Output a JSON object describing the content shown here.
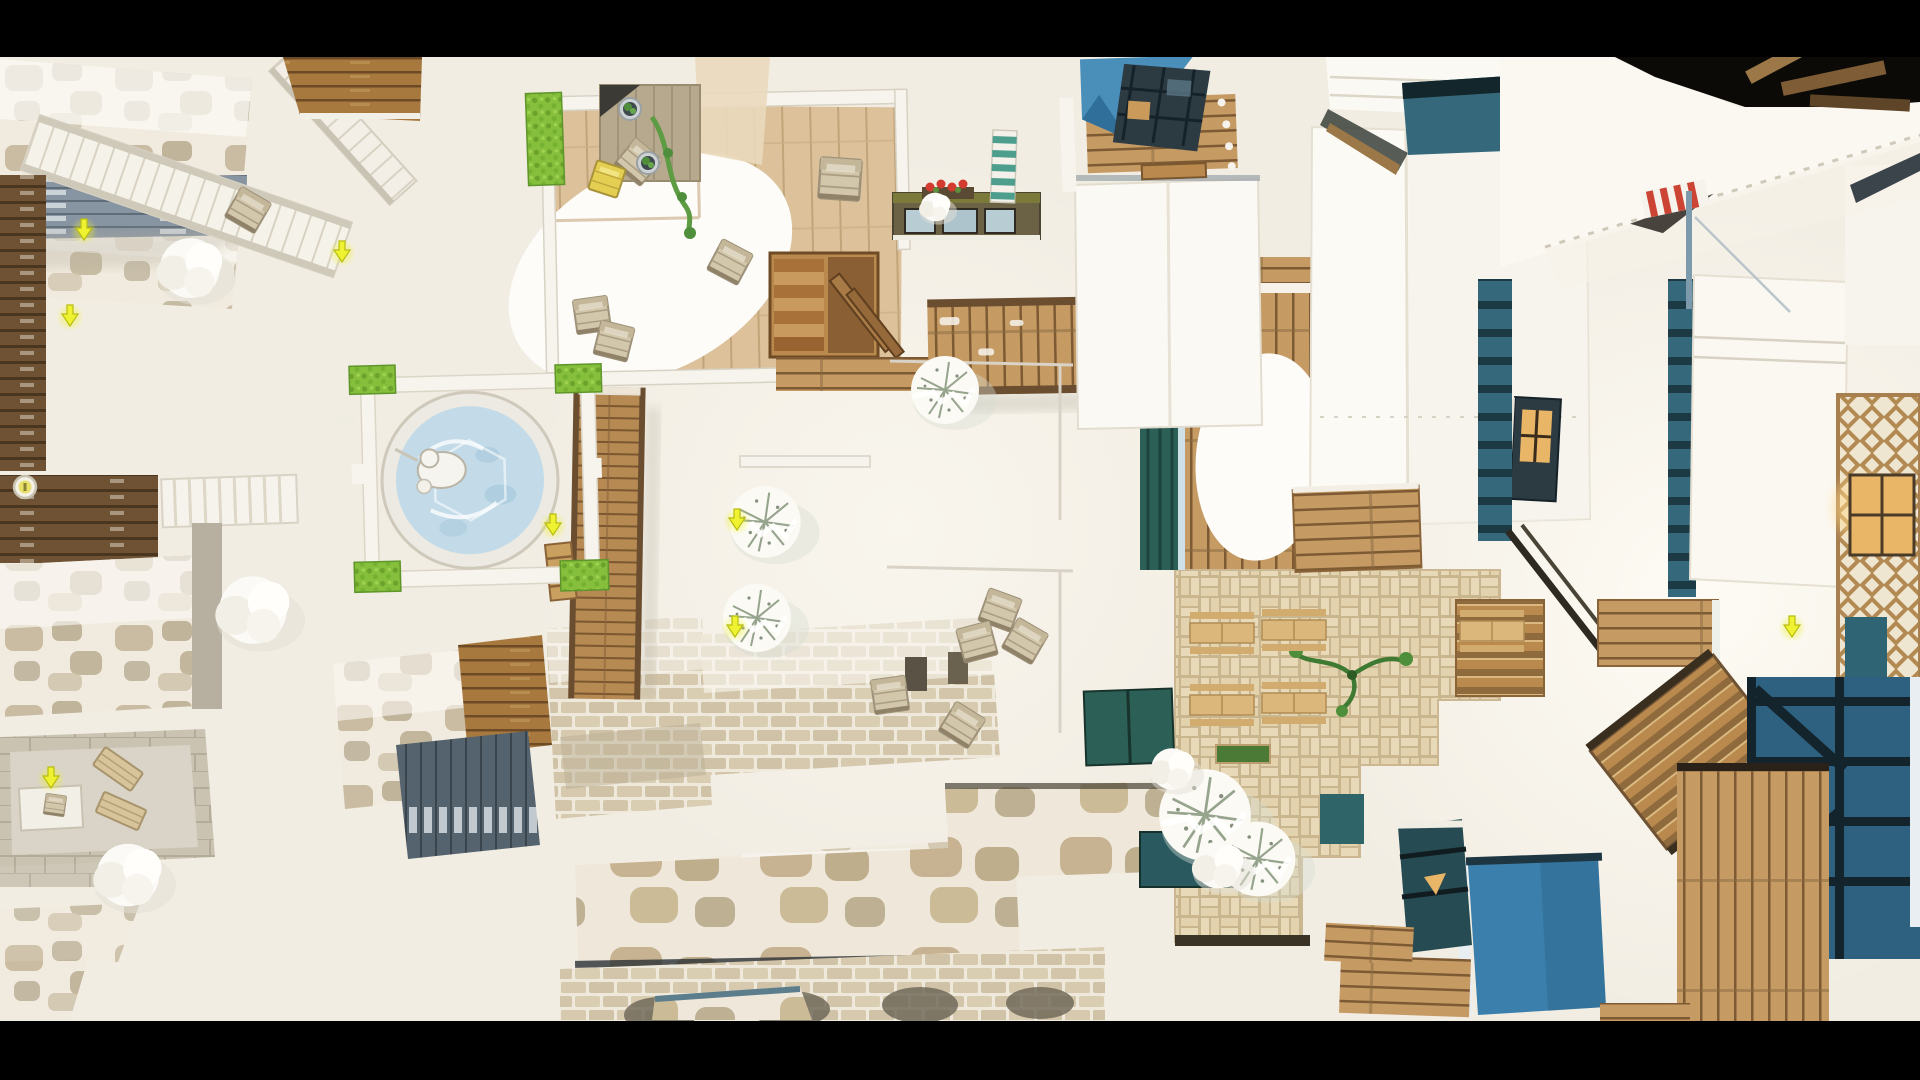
{
  "viewport": {
    "description": "top-down orthographic view of a snowy alpine village game map",
    "letterbox": {
      "color": "#000000",
      "top_height_px": 57,
      "bottom_height_px": 59
    },
    "content_size": {
      "width": 1920,
      "height": 964
    }
  },
  "palette": {
    "letterbox": "#000000",
    "ground": "#f2ede3",
    "ground_bright": "#faf7f0",
    "snow": "#fcfbf7",
    "wall_white": "#f7f4ed",
    "edge_light": "#d9d3c5",
    "floor_wood": "#dcc19a",
    "deck_wood": "#c59a63",
    "deck_gap": "#7d5a33",
    "rich_wood": "#a8793f",
    "dark_wood": "#6e5233",
    "stair_wood": "#b9894e",
    "stone_tan": "#c9bca2",
    "stone_gray": "#b3a78c",
    "slate": "#8794a1",
    "slate_dark": "#55636e",
    "teal_wall": "#35687a",
    "teal_beam": "#1d3a44",
    "teal_door": "#2c5f56",
    "steel_blue": "#2e6180",
    "bright_blue": "#3b80ad",
    "sky_blue": "#4a8fba",
    "window_dark": "#2c3a42",
    "amber": "#e9b566",
    "hedge": "#86bf3c",
    "plant": "#4f8f3b",
    "water": "#c3dbe8",
    "water_deep": "#9cc2d6",
    "crate": "#d2c6ab",
    "crate_edge": "#9d9179",
    "loot": "#eef230",
    "awning_red": "#cc4434",
    "flower_red": "#d23b2e",
    "paver": "#e8dab8",
    "paver_gap": "#c9b68e",
    "table_tan": "#dcb77c",
    "olive_dark": "#6b6246"
  },
  "scene": {
    "loot_markers": [
      {
        "t": "translate(342,196)"
      },
      {
        "t": "translate(70,260)"
      },
      {
        "t": "translate(84,174)"
      },
      {
        "t": "translate(553,469)"
      },
      {
        "t": "translate(737,464)"
      },
      {
        "t": "translate(735,571)"
      },
      {
        "t": "translate(51,722)"
      },
      {
        "t": "translate(1792,571)"
      }
    ],
    "item_badge": {
      "t": "translate(25,430)"
    },
    "crates": [
      {
        "t": "translate(638,105) rotate(40)"
      },
      {
        "t": "translate(730,205) rotate(28)"
      },
      {
        "t": "translate(592,258) rotate(-8)"
      },
      {
        "t": "translate(614,284) rotate(14)"
      },
      {
        "t": "translate(840,122) rotate(4) scale(1.2)"
      },
      {
        "t": "translate(248,153) rotate(30)"
      },
      {
        "t": "translate(1000,553) rotate(20)"
      },
      {
        "t": "translate(977,585) rotate(-15)"
      },
      {
        "t": "translate(1025,584) rotate(30)"
      },
      {
        "t": "translate(890,638) rotate(-8)"
      },
      {
        "t": "translate(962,668) rotate(32)"
      },
      {
        "t": "translate(55,748) rotate(8) scale(0.6)"
      }
    ],
    "yellow_crates": [
      {
        "t": "translate(607,122) rotate(18)"
      }
    ],
    "benches": [
      {
        "t": "translate(118,712) rotate(35)"
      },
      {
        "t": "translate(121,754) rotate(24)"
      }
    ],
    "picnic_tables": [
      {
        "t": "translate(1222,576)"
      },
      {
        "t": "translate(1294,573)"
      },
      {
        "t": "translate(1222,648)"
      },
      {
        "t": "translate(1294,646)"
      },
      {
        "t": "translate(1492,574)"
      }
    ],
    "snow_pines": [
      {
        "t": "translate(945,333)"
      },
      {
        "t": "translate(765,465) scale(1.05)"
      },
      {
        "t": "translate(757,561)"
      },
      {
        "t": "translate(1205,758) scale(1.35)"
      },
      {
        "t": "translate(1258,802) scale(1.1)"
      }
    ],
    "snow_puffs": [
      {
        "t": "translate(190,211) scale(1.15)"
      },
      {
        "t": "translate(253,553) scale(1.3)"
      },
      {
        "t": "translate(1172,712) scale(0.8)"
      },
      {
        "t": "translate(1218,808) scale(0.9)"
      },
      {
        "t": "translate(128,818) scale(1.2)"
      },
      {
        "t": "translate(935,150) scale(0.55)"
      }
    ],
    "potted_plants": [
      {
        "t": "translate(630,52)"
      },
      {
        "t": "translate(648,106)"
      }
    ]
  }
}
